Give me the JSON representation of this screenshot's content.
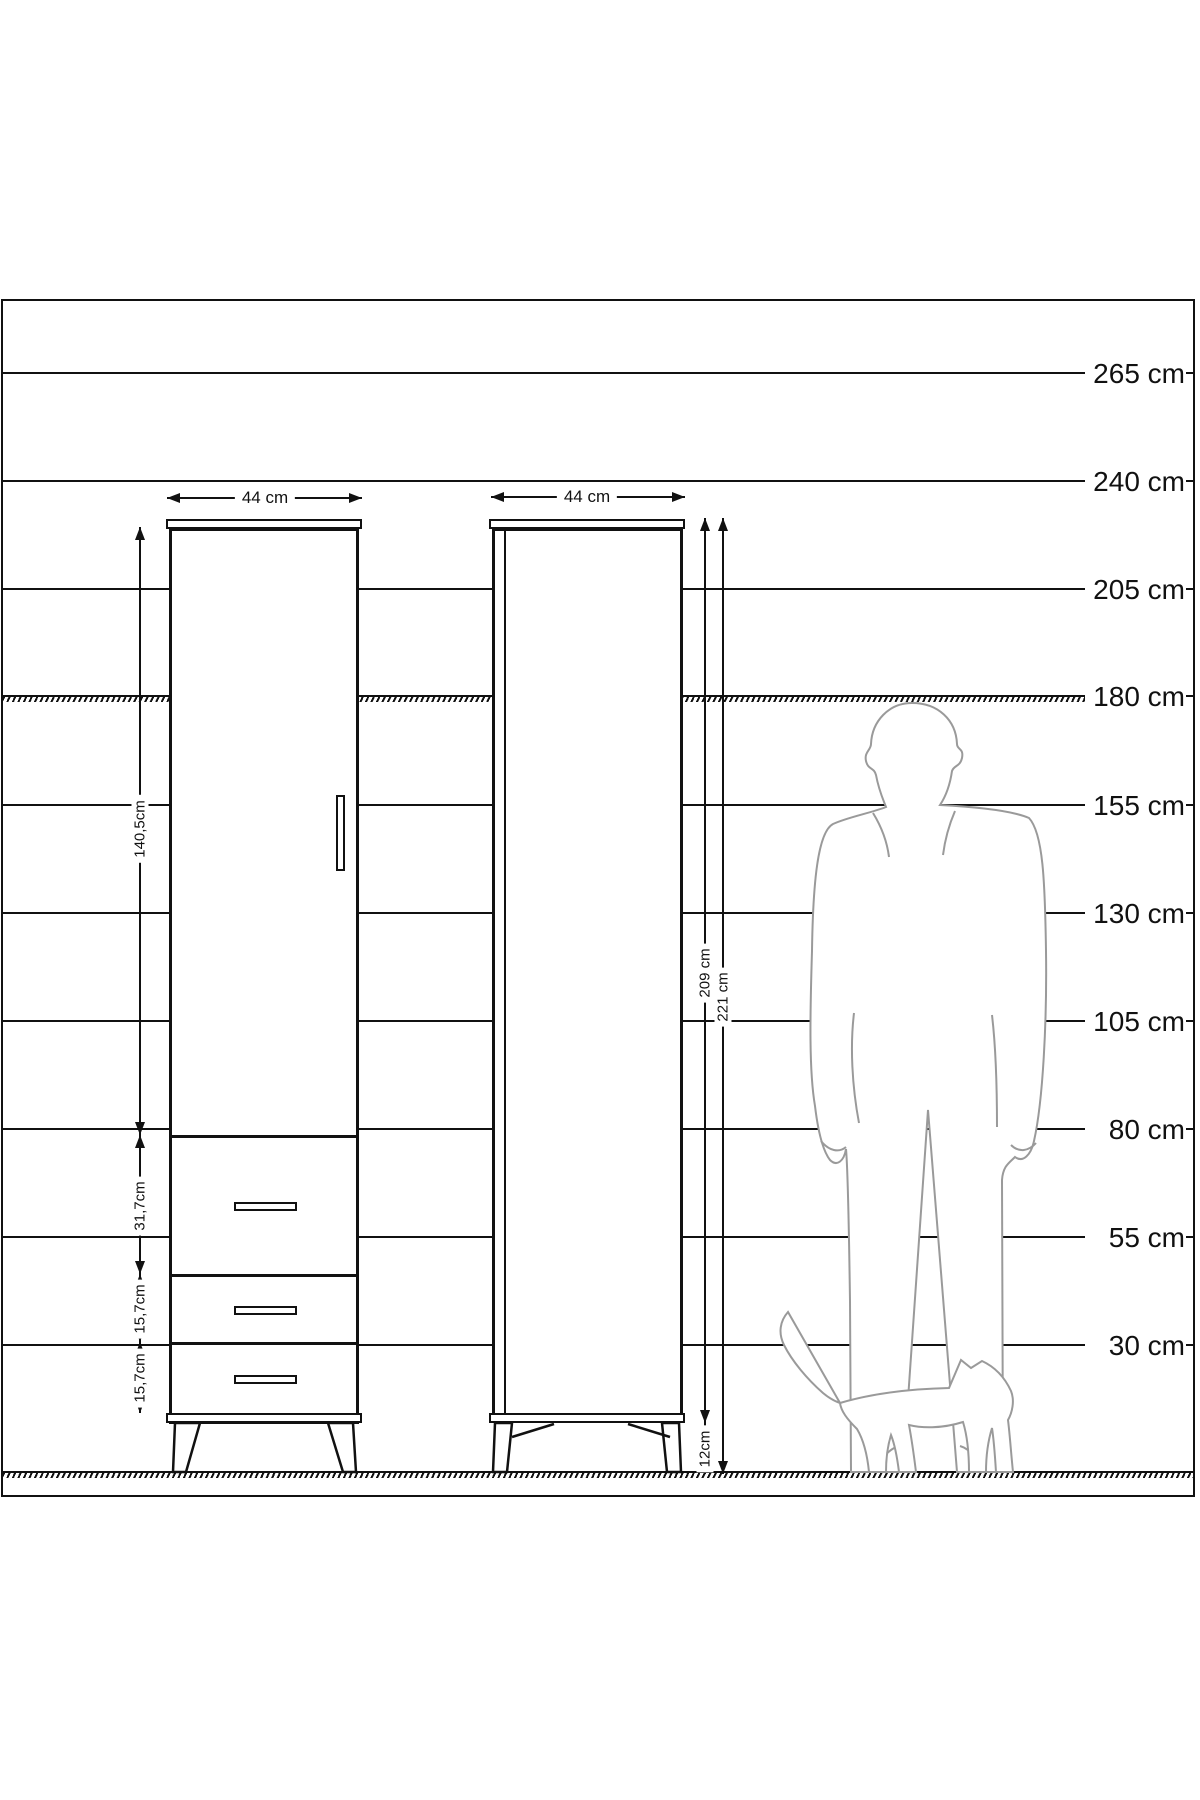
{
  "diagram": {
    "unit": "cm",
    "colors": {
      "line": "#111111",
      "silhouette": "#9a9a9a",
      "background": "#ffffff"
    },
    "height_scale": {
      "lines": [
        {
          "label": "265 cm",
          "y": 71,
          "style": "solid"
        },
        {
          "label": "240 cm",
          "y": 179,
          "style": "solid"
        },
        {
          "label": "205 cm",
          "y": 287,
          "style": "solid"
        },
        {
          "label": "180 cm",
          "y": 394,
          "style": "hatched"
        },
        {
          "label": "155 cm",
          "y": 503,
          "style": "solid"
        },
        {
          "label": "130 cm",
          "y": 611,
          "style": "solid"
        },
        {
          "label": "105 cm",
          "y": 719,
          "style": "solid"
        },
        {
          "label": "80 cm",
          "y": 827,
          "style": "solid"
        },
        {
          "label": "55 cm",
          "y": 935,
          "style": "solid"
        },
        {
          "label": "30 cm",
          "y": 1043,
          "style": "solid"
        }
      ],
      "ground_y": 1170
    },
    "left_cabinet": {
      "width_label": "44 cm",
      "door_height_label": "140,5cm",
      "drawer_height_labels": [
        "31,7cm",
        "15,7cm",
        "15,7cm"
      ]
    },
    "right_cabinet": {
      "width_label": "44 cm",
      "body_height_label": "209 cm",
      "total_height_label": "221 cm",
      "leg_height_label": "12cm"
    }
  }
}
